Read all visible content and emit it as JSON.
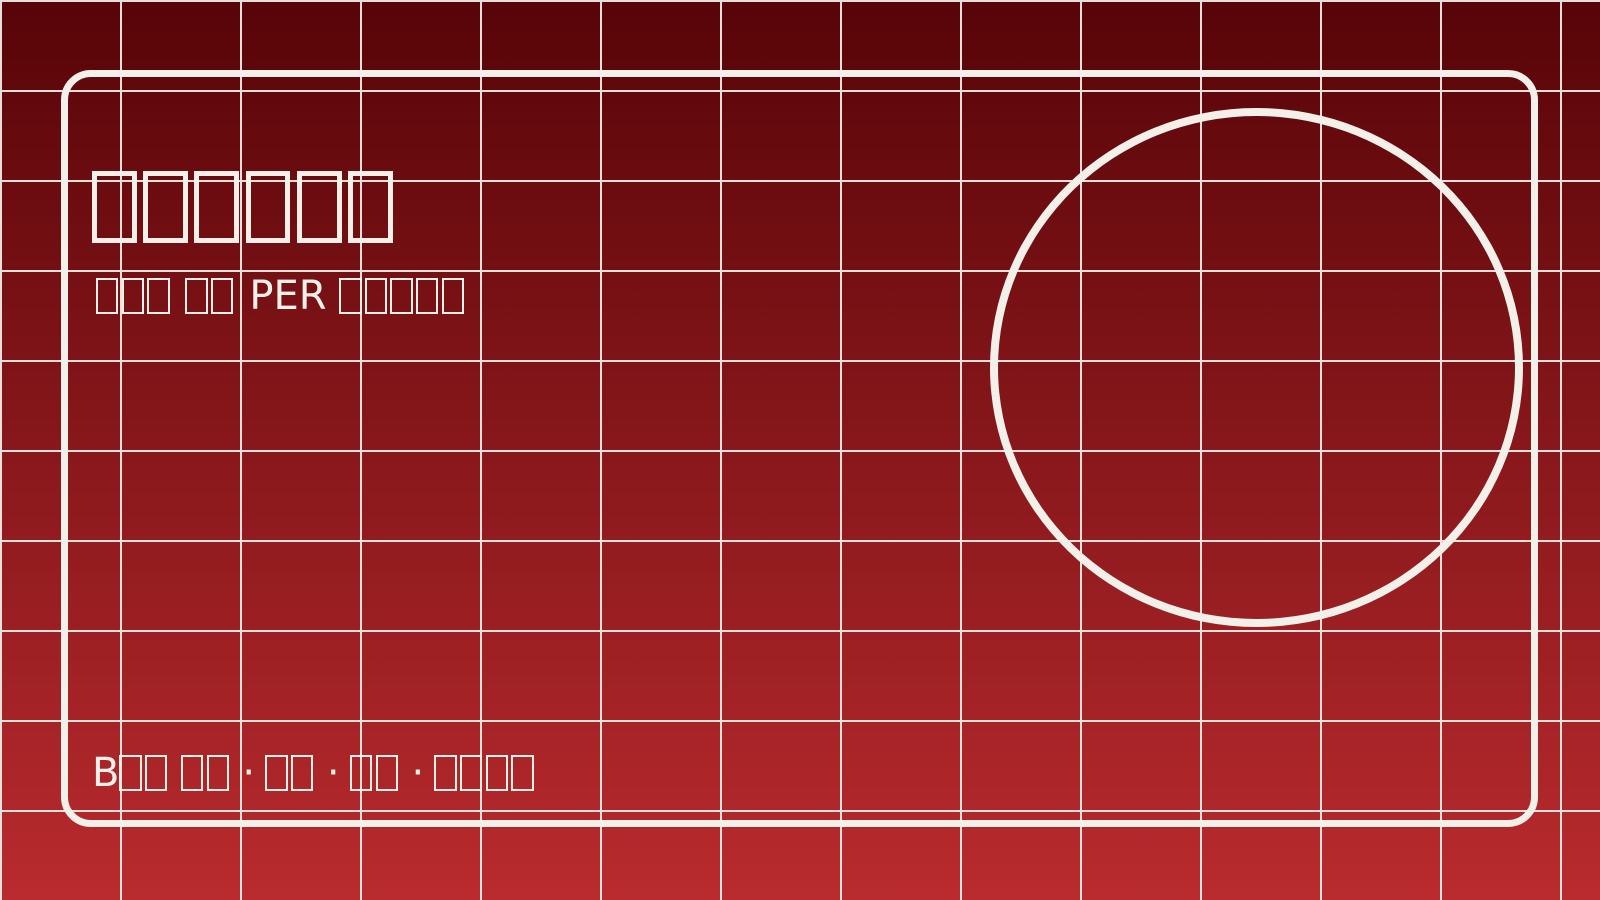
{
  "colors": {
    "background_top": "#570408",
    "background_bottom": "#b92b2e",
    "line": "#f3f0ea"
  },
  "slide": {
    "title": {
      "runs": [
        {
          "tofu": 6
        }
      ]
    },
    "subtitle": {
      "runs": [
        {
          "tofu": 3
        },
        {
          "text": " "
        },
        {
          "tofu": 2
        },
        {
          "text": " PER "
        },
        {
          "tofu": 5
        }
      ]
    },
    "footer": {
      "runs": [
        {
          "text": "B"
        },
        {
          "tofu": 2
        },
        {
          "text": " "
        },
        {
          "tofu": 2
        },
        {
          "text": " · "
        },
        {
          "tofu": 2
        },
        {
          "text": " · "
        },
        {
          "tofu": 2
        },
        {
          "text": " · "
        },
        {
          "tofu": 4
        }
      ]
    }
  }
}
